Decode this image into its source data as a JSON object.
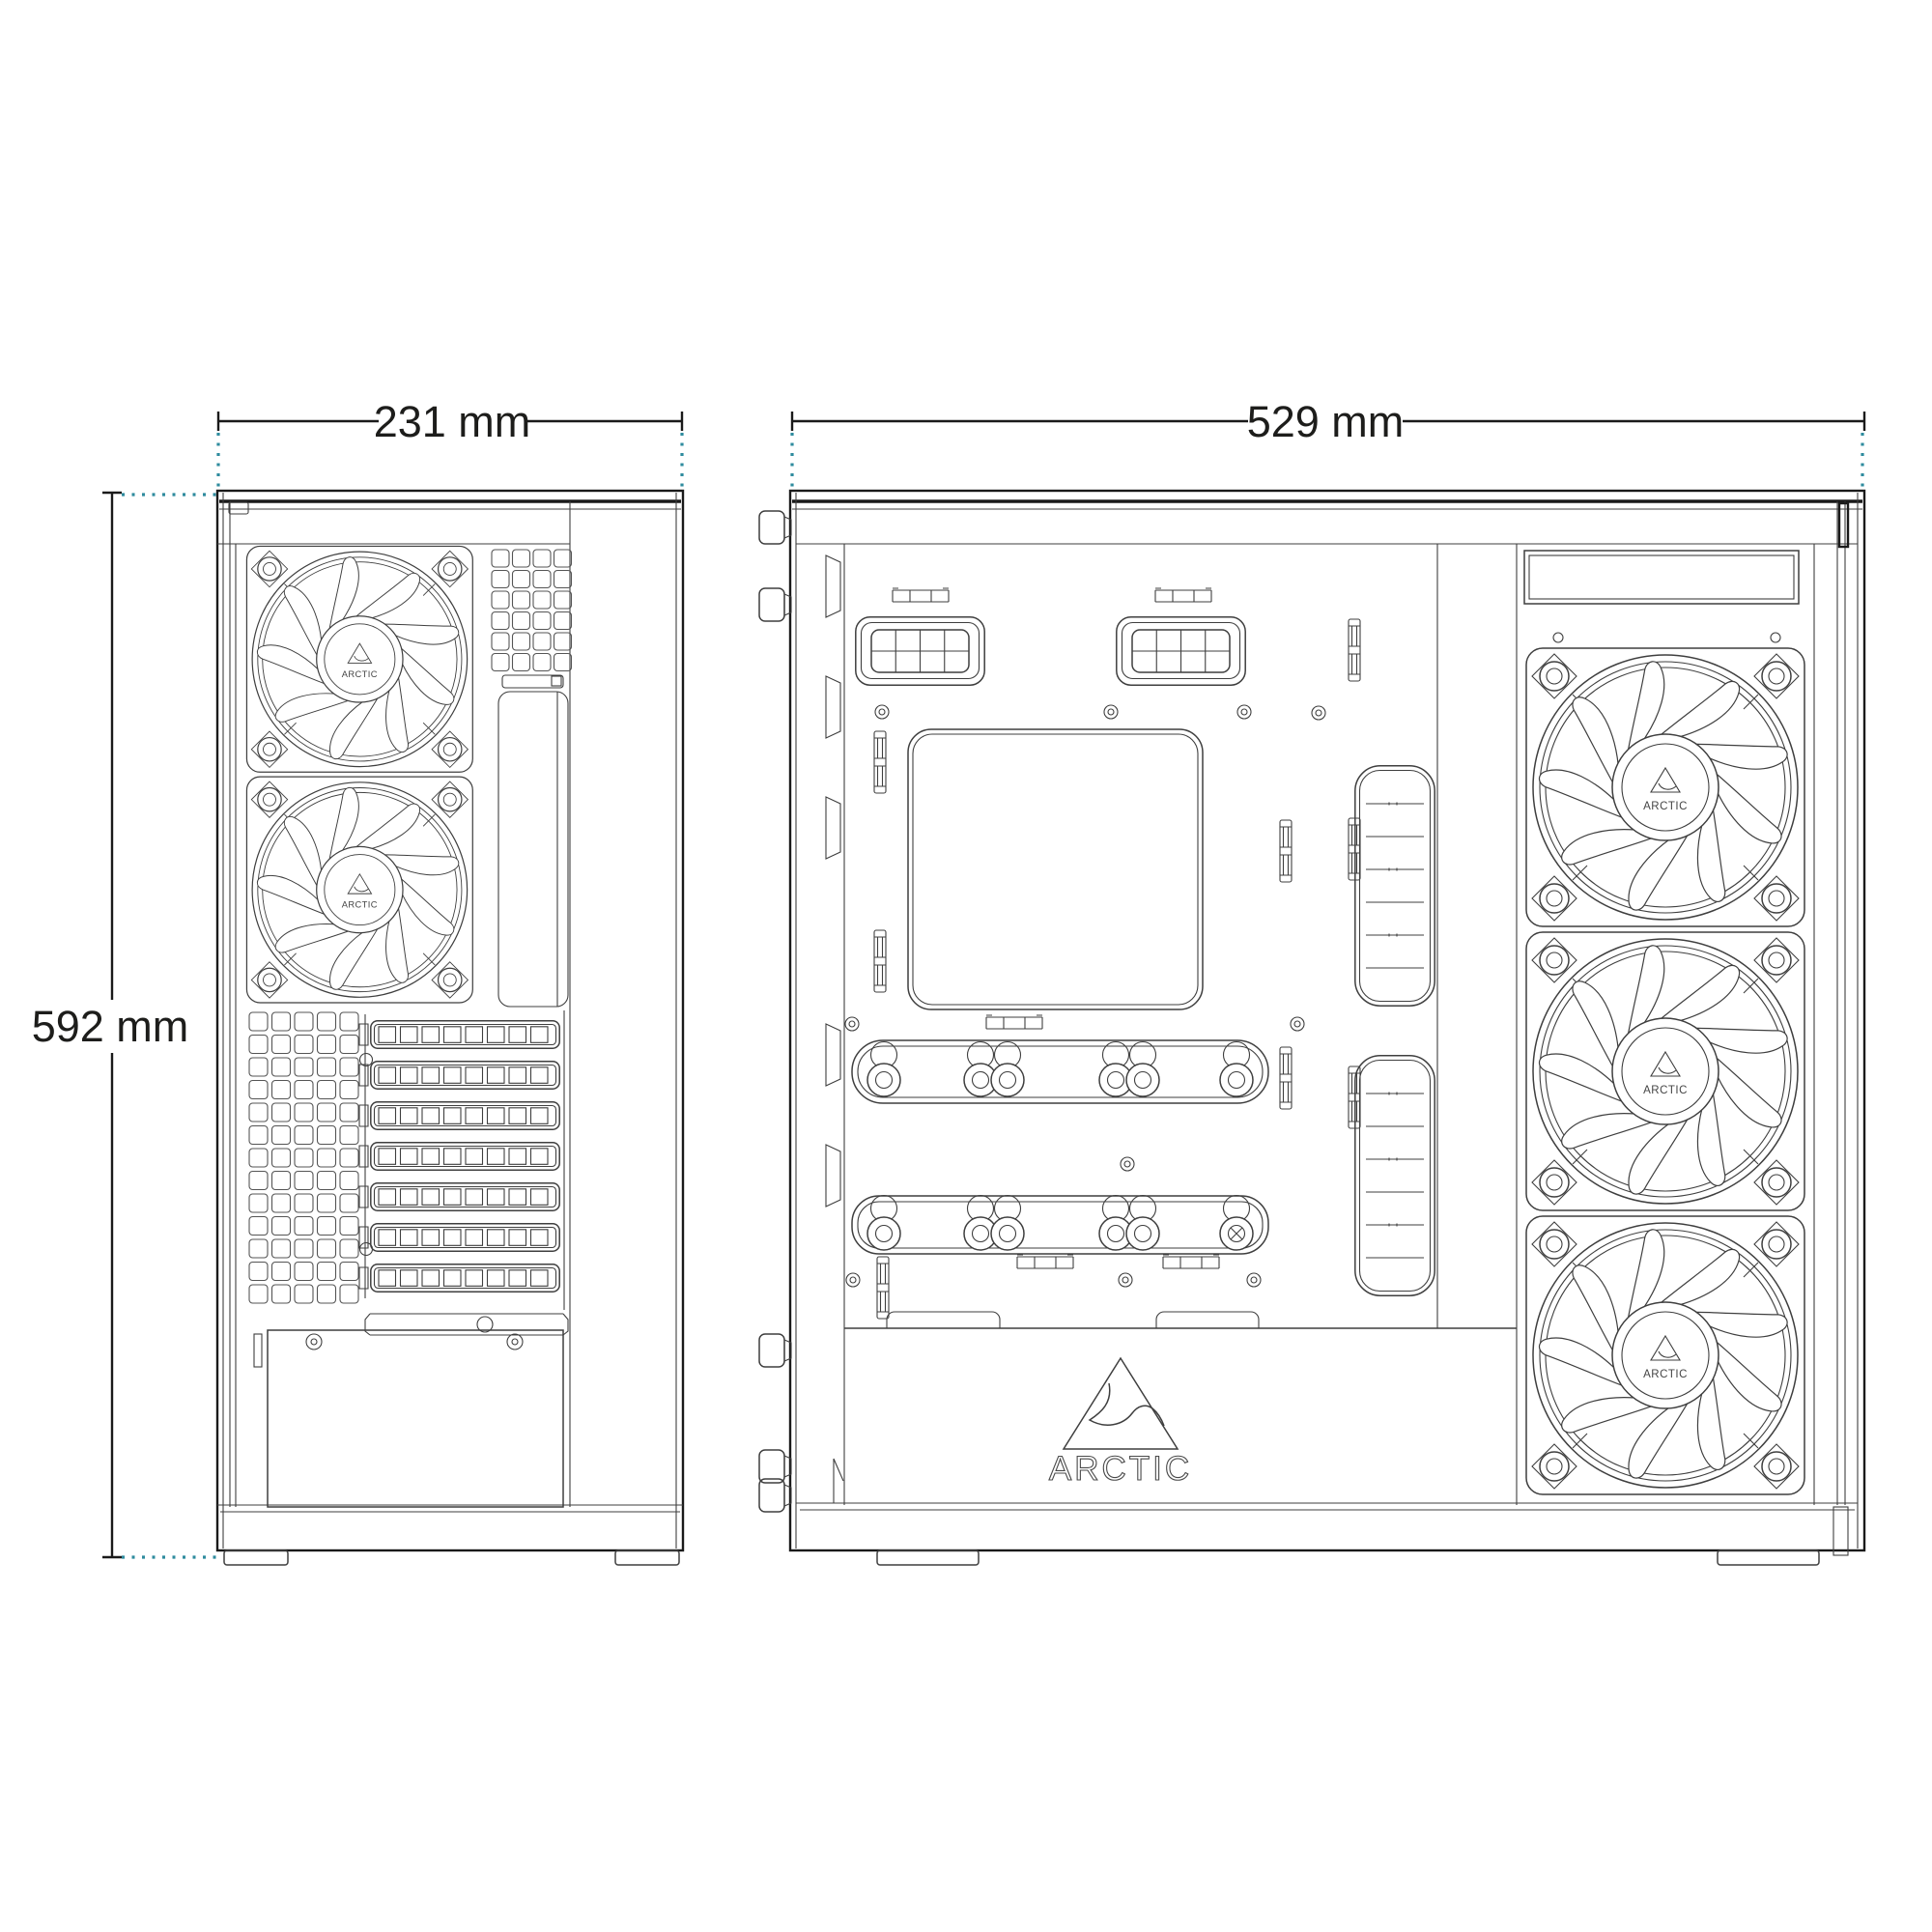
{
  "brand": {
    "name": "ARCTIC"
  },
  "dimension_labels": {
    "front_width": "231 mm",
    "side_depth": "529 mm",
    "height": "592 mm"
  },
  "colors": {
    "background": "#ffffff",
    "line": "#3f3f3f",
    "strong": "#1a1a1a",
    "extension": "#2e8b9e",
    "text": "#1d1d1b"
  },
  "views": {
    "front": {
      "fans": 2,
      "expansion_slots": 7
    },
    "side": {
      "fans": 3
    }
  }
}
